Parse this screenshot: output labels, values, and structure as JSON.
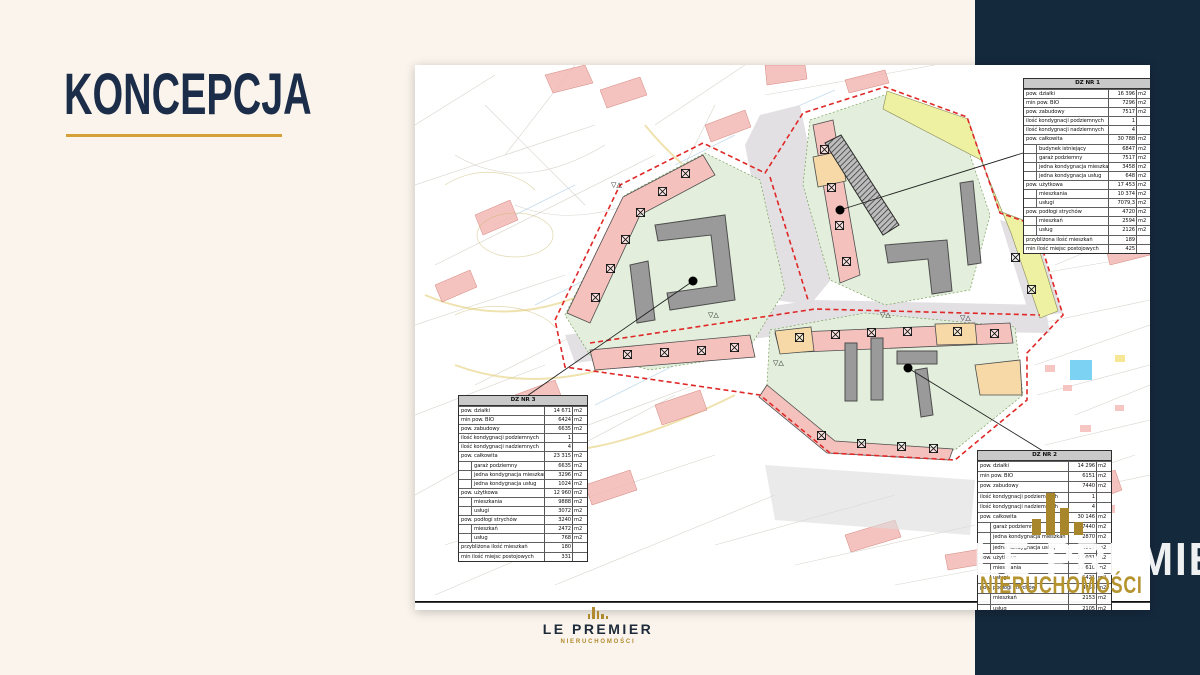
{
  "slide": {
    "title": "KONCEPCJA",
    "background_color": "#FAF4EC",
    "navy_color": "#15293D",
    "accent_gold": "#D5A035"
  },
  "brand": {
    "logo_name": "LE PREMIER",
    "logo_subtitle": "NIERUCHOMOŚCI",
    "watermark_name": "LE PREMIER",
    "watermark_subtitle": "NIERUCHOMOŚCI",
    "logo_icon": "bar-columns-icon"
  },
  "plan": {
    "boundary_color": "#E02828",
    "parcel_fill": "#E3EFDC",
    "building_pink": "#F4C1BD",
    "building_orange": "#F6D9A6",
    "existing_strip_yellow": "#EEF0A2",
    "road_gray": "#E2E0E3",
    "tables": [
      {
        "id": "dz1",
        "title": "DZ NR 1",
        "rows": [
          {
            "label": "pow. działki",
            "value": "16 396",
            "unit": "m2",
            "indent": false
          },
          {
            "label": "min pow. BIO",
            "value": "7296",
            "unit": "m2",
            "indent": false
          },
          {
            "label": "pow. zabudowy",
            "value": "7517",
            "unit": "m2",
            "indent": false
          },
          {
            "label": "ilość kondygnacji podziemnych",
            "value": "1",
            "unit": "",
            "indent": false
          },
          {
            "label": "ilość kondygnacji nadziemnych",
            "value": "4",
            "unit": "",
            "indent": false
          },
          {
            "label": "pow. całkowita",
            "value": "30 788",
            "unit": "m2",
            "indent": false
          },
          {
            "label": "budynek istniejący",
            "value": "6847",
            "unit": "m2",
            "indent": true
          },
          {
            "label": "garaż podziemny",
            "value": "7517",
            "unit": "m2",
            "indent": true
          },
          {
            "label": "jedna kondygnacja mieszkań",
            "value": "3458",
            "unit": "m2",
            "indent": true
          },
          {
            "label": "jedna kondygnacja usług",
            "value": "648",
            "unit": "m2",
            "indent": true
          },
          {
            "label": "pow. użytkowa",
            "value": "17 453",
            "unit": "m2",
            "indent": false
          },
          {
            "label": "mieszkania",
            "value": "10 374",
            "unit": "m2",
            "indent": true
          },
          {
            "label": "usługi",
            "value": "7079,3",
            "unit": "m2",
            "indent": true
          },
          {
            "label": "pow. podłogi strychów",
            "value": "4720",
            "unit": "m2",
            "indent": false
          },
          {
            "label": "mieszkań",
            "value": "2594",
            "unit": "m2",
            "indent": true
          },
          {
            "label": "usług",
            "value": "2126",
            "unit": "m2",
            "indent": true
          },
          {
            "label": "przybliżona ilość mieszkań",
            "value": "189",
            "unit": "",
            "indent": false
          },
          {
            "label": "min ilość miejsc postojowych",
            "value": "425",
            "unit": "",
            "indent": false
          }
        ]
      },
      {
        "id": "dz2",
        "title": "DZ NR 2",
        "rows": [
          {
            "label": "pow. działki",
            "value": "14 296",
            "unit": "m2",
            "indent": false
          },
          {
            "label": "min pow. BIO",
            "value": "6151",
            "unit": "m2",
            "indent": false
          },
          {
            "label": "pow. zabudowy",
            "value": "7440",
            "unit": "m2",
            "indent": false
          },
          {
            "label": "ilość kondygnacji podziemnych",
            "value": "1",
            "unit": "",
            "indent": false
          },
          {
            "label": "ilość kondygnacji nadziemnych",
            "value": "4",
            "unit": "",
            "indent": false
          },
          {
            "label": "pow. całkowita",
            "value": "30 146",
            "unit": "m2",
            "indent": false
          },
          {
            "label": "garaż podziemny",
            "value": "7440",
            "unit": "m2",
            "indent": true
          },
          {
            "label": "jedna kondygnacja mieszkań",
            "value": "2870",
            "unit": "m2",
            "indent": true
          },
          {
            "label": "jedna kondygnacja usług",
            "value": "2807",
            "unit": "m2",
            "indent": true
          },
          {
            "label": "pow. użytkowa",
            "value": "17 031",
            "unit": "m2",
            "indent": false
          },
          {
            "label": "mieszkania",
            "value": "11 610",
            "unit": "m2",
            "indent": true
          },
          {
            "label": "usługi",
            "value": "5421",
            "unit": "m2",
            "indent": true
          },
          {
            "label": "pow. podłogi strychów",
            "value": "4258",
            "unit": "m2",
            "indent": false
          },
          {
            "label": "mieszkań",
            "value": "2153",
            "unit": "m2",
            "indent": true
          },
          {
            "label": "usług",
            "value": "2105",
            "unit": "m2",
            "indent": true
          },
          {
            "label": "przybliżona ilość mieszkań",
            "value": "187",
            "unit": "",
            "indent": false
          }
        ]
      },
      {
        "id": "dz3",
        "title": "DZ NR 3",
        "rows": [
          {
            "label": "pow. działki",
            "value": "14 671",
            "unit": "m2",
            "indent": false
          },
          {
            "label": "min pow. BIO",
            "value": "6424",
            "unit": "m2",
            "indent": false
          },
          {
            "label": "pow. zabudowy",
            "value": "6635",
            "unit": "m2",
            "indent": false
          },
          {
            "label": "ilość kondygnacji podziemnych",
            "value": "1",
            "unit": "",
            "indent": false
          },
          {
            "label": "ilość kondygnacji nadziemnych",
            "value": "4",
            "unit": "",
            "indent": false
          },
          {
            "label": "pow. całkowita",
            "value": "23 315",
            "unit": "m2",
            "indent": false
          },
          {
            "label": "garaż podziemny",
            "value": "6635",
            "unit": "m2",
            "indent": true
          },
          {
            "label": "jedna kondygnacja mieszkań",
            "value": "3296",
            "unit": "m2",
            "indent": true
          },
          {
            "label": "jedna kondygnacja usług",
            "value": "1024",
            "unit": "m2",
            "indent": true
          },
          {
            "label": "pow. użytkowa",
            "value": "12 960",
            "unit": "m2",
            "indent": false
          },
          {
            "label": "mieszkania",
            "value": "9888",
            "unit": "m2",
            "indent": true
          },
          {
            "label": "usługi",
            "value": "3072",
            "unit": "m2",
            "indent": true
          },
          {
            "label": "pow. podłogi strychów",
            "value": "3240",
            "unit": "m2",
            "indent": false
          },
          {
            "label": "mieszkań",
            "value": "2472",
            "unit": "m2",
            "indent": true
          },
          {
            "label": "usług",
            "value": "768",
            "unit": "m2",
            "indent": true
          },
          {
            "label": "przybliżona ilość mieszkań",
            "value": "180",
            "unit": "",
            "indent": false
          },
          {
            "label": "min ilość miejsc postojowych",
            "value": "331",
            "unit": "",
            "indent": false
          }
        ]
      }
    ]
  }
}
